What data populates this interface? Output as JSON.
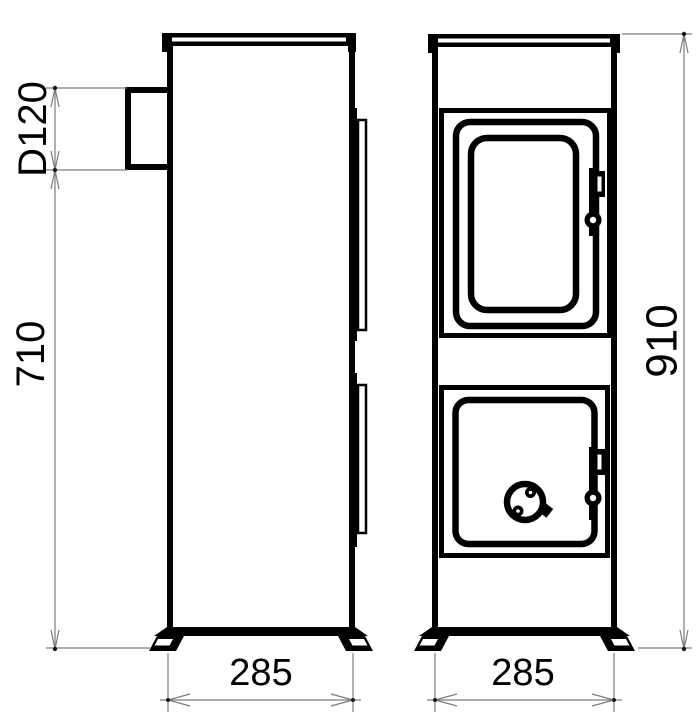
{
  "colors": {
    "background": "#ffffff",
    "line": "#000000",
    "dimension_line": "#7d7d7d",
    "text": "#000000"
  },
  "dimensions": {
    "flue_diameter": {
      "label": "D120"
    },
    "height_to_flue": {
      "label": "710"
    },
    "overall_height": {
      "label": "910"
    },
    "side_depth": {
      "label": "285"
    },
    "front_width": {
      "label": "285"
    }
  }
}
